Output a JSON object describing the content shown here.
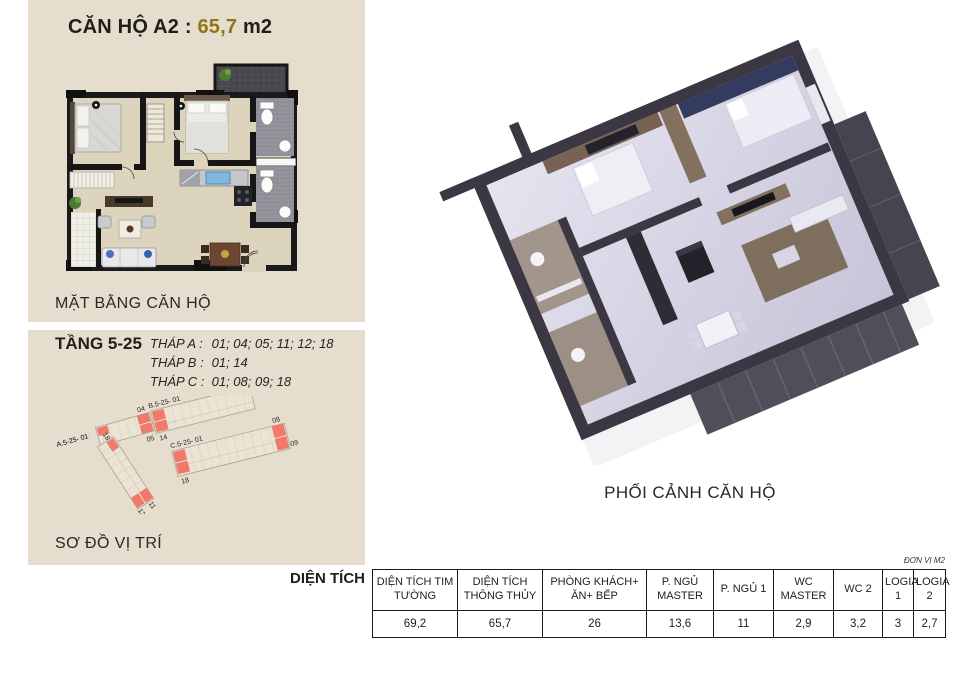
{
  "title": {
    "prefix": "CĂN HỘ A2 : ",
    "area": "65,7",
    "suffix": " m2",
    "accent_color": "#8f7519"
  },
  "panel_bg": "#e5decf",
  "captions": {
    "floorplan": "MẶT BẰNG CĂN HỘ",
    "sitemap": "SƠ ĐỒ VỊ TRÍ",
    "perspective": "PHỐI CẢNH CĂN HỘ"
  },
  "floors": {
    "label": "TẦNG 5-25",
    "towers": [
      {
        "name": "THÁP A :",
        "units": "01; 04; 05; 11; 12; 18"
      },
      {
        "name": "THÁP B :",
        "units": "01; 14"
      },
      {
        "name": "THÁP C :",
        "units": "01; 08; 09; 18"
      }
    ]
  },
  "sitemap": {
    "highlight_color": "#f0796c",
    "buildings": [
      {
        "label": "A.5-25- 01",
        "units": [
          "04",
          "05",
          "18",
          "11",
          "12"
        ]
      },
      {
        "label": "B.5-25- 01",
        "units": [
          "14"
        ]
      },
      {
        "label": "C.5-25- 01",
        "units": [
          "18",
          "08",
          "09"
        ]
      }
    ]
  },
  "area_table": {
    "label": "DIỆN TÍCH",
    "unit_note": "ĐƠN VỊ M2",
    "columns": [
      "DIỆN TÍCH TIM TƯỜNG",
      "DIỆN TÍCH THÔNG THỦY",
      "PHÒNG KHÁCH+ ĂN+ BẾP",
      "P. NGỦ MASTER",
      "P. NGỦ 1",
      "WC MASTER",
      "WC 2",
      "LOGIA 1",
      "LOGIA 2"
    ],
    "values": [
      "69,2",
      "65,7",
      "26",
      "13,6",
      "11",
      "2,9",
      "3,2",
      "3",
      "2,7"
    ]
  }
}
